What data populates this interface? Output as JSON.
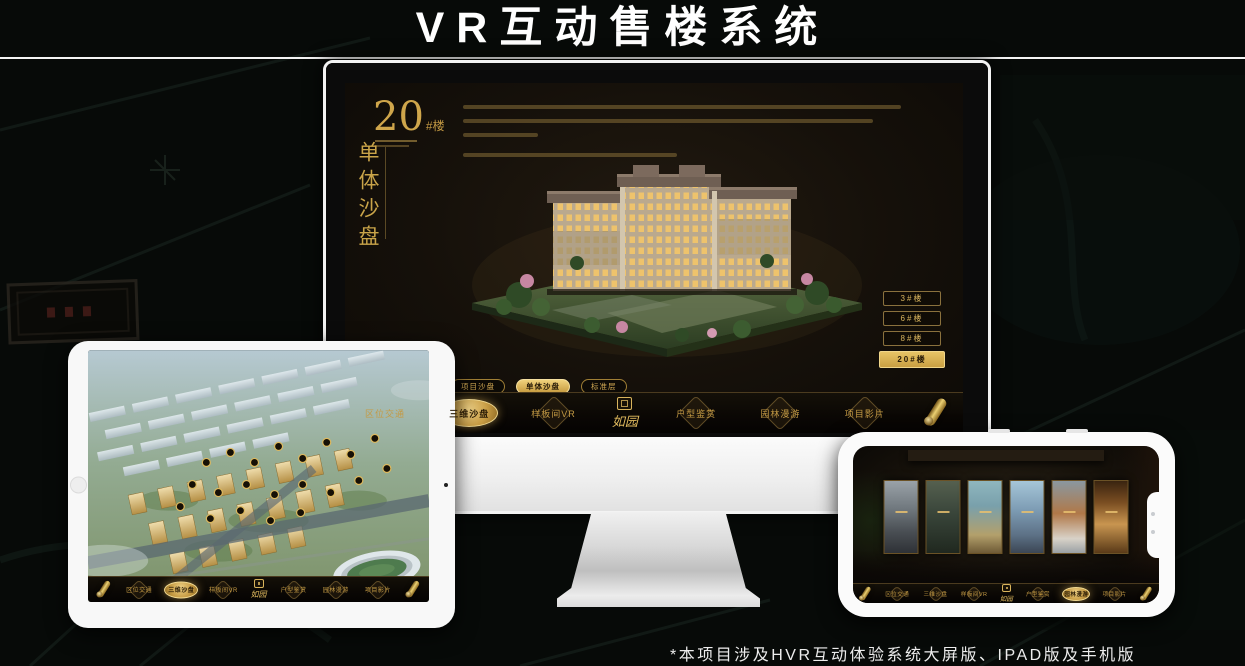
{
  "header": {
    "title": "VR互动售楼系统"
  },
  "footer": {
    "caption": "*本项目涉及HVR互动体验系统大屏版、IPAD版及手机版"
  },
  "theme": {
    "accent_gold": "#D2AA54",
    "screen_background": "#161009",
    "device_frame": "#F5F5F5",
    "page_background": "#070A08"
  },
  "brand": {
    "logo": "如园"
  },
  "desktop": {
    "unit_panel": {
      "number": "20",
      "suffix": "#楼",
      "vertical_title": "单体沙盘"
    },
    "floor_buttons": [
      {
        "label": "3#楼",
        "active": false
      },
      {
        "label": "6#楼",
        "active": false
      },
      {
        "label": "8#楼",
        "active": false
      },
      {
        "label": "20#楼",
        "active": true
      }
    ],
    "sub_tabs": [
      {
        "label": "项目沙盘",
        "active": false
      },
      {
        "label": "单体沙盘",
        "active": true
      },
      {
        "label": "标准层",
        "active": false
      }
    ],
    "nav_items": [
      {
        "label": "区位交通",
        "active": false
      },
      {
        "label": "三维沙盘",
        "active": true
      },
      {
        "label": "样板间VR",
        "active": false
      },
      {
        "label": "户型鉴赏",
        "active": false
      },
      {
        "label": "园林漫游",
        "active": false
      },
      {
        "label": "项目影片",
        "active": false
      }
    ]
  },
  "tablet": {
    "sub_tabs": [
      {
        "label": "项目沙盘",
        "active": true
      },
      {
        "label": "单体沙盘",
        "active": false
      },
      {
        "label": "标准层",
        "active": false
      }
    ],
    "nav_items": [
      {
        "label": "区位交通",
        "active": false
      },
      {
        "label": "三维沙盘",
        "active": true
      },
      {
        "label": "样板间VR",
        "active": false
      },
      {
        "label": "户型鉴赏",
        "active": false
      },
      {
        "label": "园林漫游",
        "active": false
      },
      {
        "label": "项目影片",
        "active": false
      }
    ]
  },
  "phone": {
    "nav_items": [
      {
        "label": "区位交通",
        "active": false
      },
      {
        "label": "三维沙盘",
        "active": false
      },
      {
        "label": "样板间VR",
        "active": false
      },
      {
        "label": "户型鉴赏",
        "active": false
      },
      {
        "label": "园林漫游",
        "active": true
      },
      {
        "label": "项目影片",
        "active": false
      }
    ]
  }
}
